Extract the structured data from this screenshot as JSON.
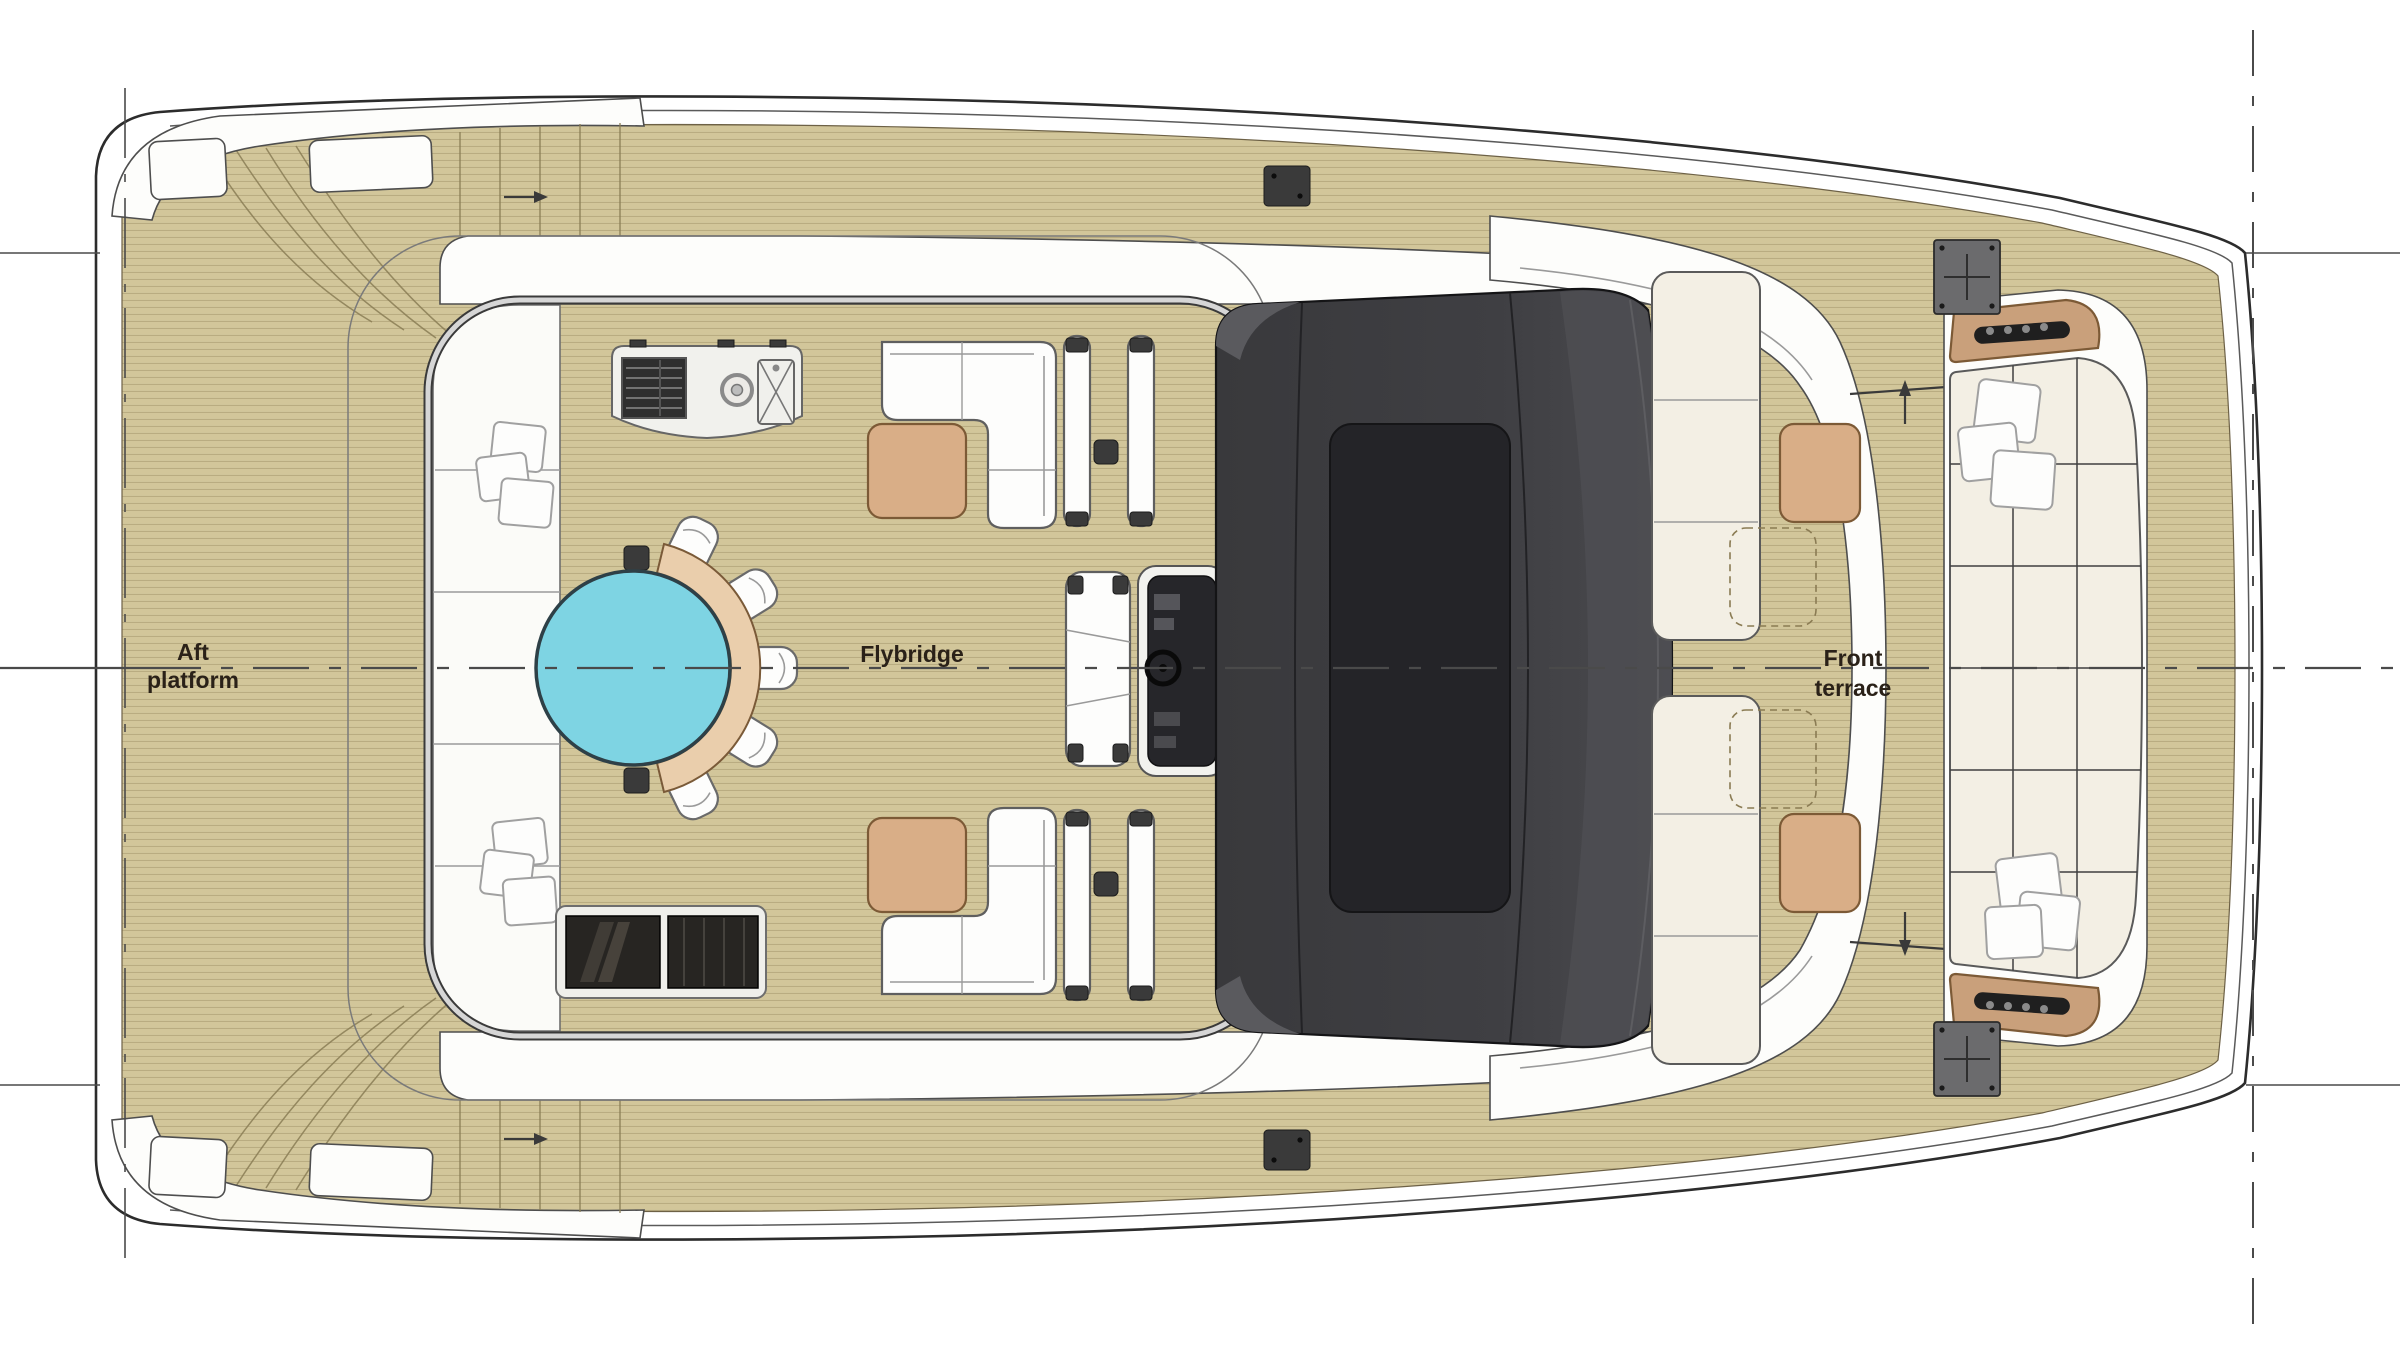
{
  "labels": {
    "aft_line1": "Aft",
    "aft_line2": "platform",
    "flybridge": "Flybridge",
    "front_line1": "Front",
    "front_line2": "terrace"
  },
  "icons": {
    "grill": "grill-icon",
    "burner": "burner-icon",
    "sink": "sink-icon",
    "steering_wheel": "steering-wheel-icon",
    "speaker": "speaker-grille-icon",
    "walk_direction": "arrow-icon"
  },
  "colors": {
    "ink": "#2a2118",
    "outline": "#2c2c2c",
    "guide": "#4a4a4a",
    "deck": "#d2c69a",
    "plank": "#a3966c",
    "deck_edge": "#6d6146",
    "hull_white": "#ffffff",
    "rail_dark": "#3a3a3a",
    "rail_light": "#d6d6d6",
    "bench_white": "#fbfbf8",
    "cushion": "#fdfdfc",
    "cushion_line": "#9b9b9b",
    "cream": "#f3efe4",
    "table_wood": "#d9ae87",
    "table_edge": "#7c5a36",
    "bench_wood": "#eaceac",
    "pool": "#7ed4e3",
    "pool_edge": "#2e4047",
    "dark_item": "#3a3a3a",
    "glass": "#272522",
    "roof_edge": "#141416",
    "hatch_gray": "#6b6b6d",
    "speaker": "#1f1f1f"
  }
}
